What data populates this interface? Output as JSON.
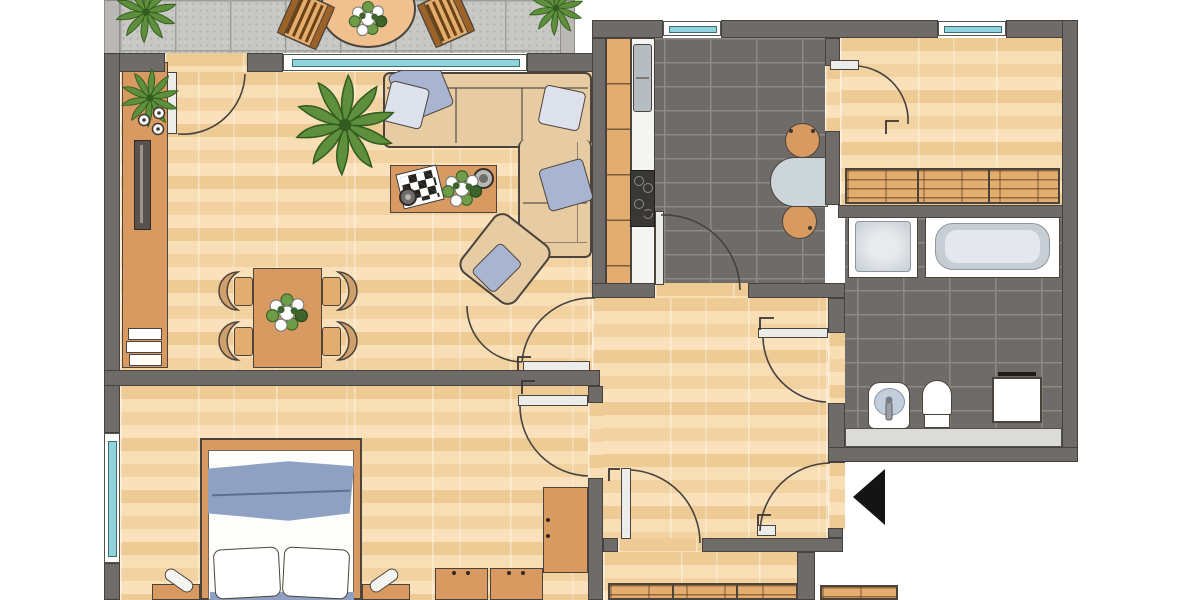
{
  "type": "apartment-floor-plan",
  "palette": {
    "background": "#ffffff",
    "wall": "#6e6b68",
    "wall_outline": "#44413e",
    "balcony_wall": "#b9b8b4",
    "wood_floor": "#f4d6a6",
    "tile_floor": "#6f6b68",
    "tile_grout": "#8d8985",
    "balcony_tile": "#c8c8c4",
    "balcony_grout": "#9f9f9b",
    "furniture_wood": "#d89a60",
    "furniture_wood_light": "#e2ad6e",
    "counter_white": "#f4f4f2",
    "sofa_beige": "#e7cba3",
    "pillow_blue": "#a9b4d0",
    "pillow_light": "#dde1ec",
    "fixture_white": "#ffffff",
    "fixture_gray": "#c6cdd4",
    "window_glass": "#8fd4dc",
    "stove_black": "#3a3836",
    "metal": "#b6bdc2",
    "plant_green": "#5e8f3d",
    "plant_dark": "#335c1e",
    "entry_arrow": "#141414",
    "table_gray": "#ccd5d9",
    "blanket_blue": "#8ea1c2"
  },
  "rooms": [
    {
      "id": "balcony",
      "floor": "gray-tile"
    },
    {
      "id": "living-room",
      "floor": "parquet"
    },
    {
      "id": "kitchen",
      "floor": "dark-tile"
    },
    {
      "id": "room-top-right",
      "floor": "parquet"
    },
    {
      "id": "bathroom",
      "floor": "dark-tile"
    },
    {
      "id": "hallway",
      "floor": "parquet"
    },
    {
      "id": "bedroom",
      "floor": "parquet"
    },
    {
      "id": "room-bottom",
      "floor": "parquet"
    }
  ],
  "inventory": {
    "balcony": [
      "round-table",
      "plant-on-table",
      "wooden-chair-left",
      "wooden-chair-right",
      "corner-plant-left",
      "corner-plant-right"
    ],
    "living_room": [
      "sideboard",
      "plant-on-sideboard",
      "candles",
      "tv",
      "book-stack",
      "corner-sofa",
      "blue-cushions",
      "coffee-table",
      "laptop",
      "flower-bouquet",
      "bowl",
      "mug",
      "armchair",
      "large-plant",
      "dining-table",
      "dining-plant",
      "dining-chairs"
    ],
    "kitchen": [
      "kitchen-counter",
      "sink",
      "stove",
      "wall-table",
      "wooden-chairs"
    ],
    "room_top_right": [
      "slatted-sideboard"
    ],
    "bathroom": [
      "shower",
      "bathtub",
      "washbasin",
      "toilet",
      "washing-machine",
      "counter-strip"
    ],
    "bedroom": [
      "double-bed",
      "blue-blanket",
      "pillows",
      "nightstands",
      "lamps",
      "tall-wardrobe",
      "wardrobe-units"
    ],
    "room_bottom": [
      "slatted-sideboard",
      "slat-bench"
    ]
  },
  "windows": [
    "living-room-window",
    "kitchen-window",
    "room-top-right-window",
    "bedroom-window"
  ],
  "doors": [
    "balcony-door",
    "living-room-door",
    "kitchen-door",
    "room-top-right-door",
    "bathroom-door",
    "bedroom-door",
    "entrance-door",
    "room-bottom-door"
  ],
  "entrance_marker": "black-triangle-pointing-left"
}
